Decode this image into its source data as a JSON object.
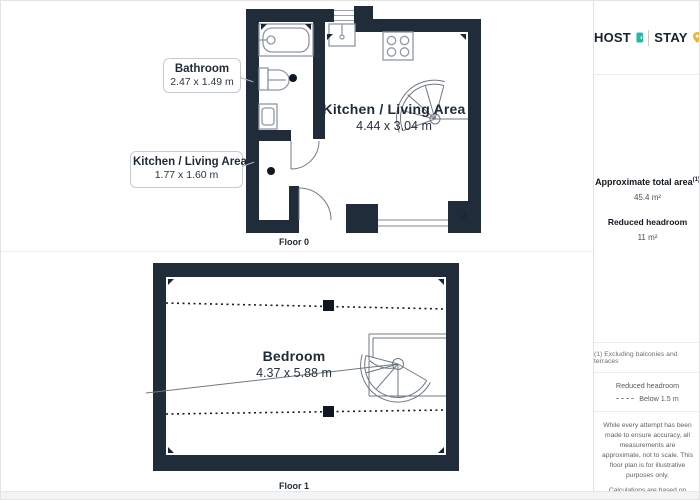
{
  "theme": {
    "wall_color": "#212c3b",
    "fixture_stroke": "#8f98a3",
    "accent_teal": "#2db5a5",
    "accent_yellow": "#f2b42c"
  },
  "logo": {
    "host": "HOST",
    "stay": "STAY"
  },
  "floor0": {
    "label": "Floor 0",
    "room": {
      "name": "Kitchen / Living Area",
      "dims": "4.44 x 3.04 m"
    },
    "callouts": [
      {
        "name": "Bathroom",
        "dims": "2.47 x 1.49 m"
      },
      {
        "name": "Kitchen / Living Area",
        "dims": "1.77 x 1.60 m"
      }
    ]
  },
  "floor1": {
    "label": "Floor 1",
    "room": {
      "name": "Bedroom",
      "dims": "4.37 x 5.88 m"
    }
  },
  "sidebar": {
    "area_title": "Approximate total area",
    "area_sup": "(1)",
    "area_value": "45.4 m²",
    "headroom_title": "Reduced headroom",
    "headroom_value": "11 m²",
    "footnote": "(1) Excluding balconies and terraces",
    "legend_title": "Reduced headroom",
    "legend_label": "Below 1.5 m",
    "disclaimer": "While every attempt has been made to ensure accuracy, all measurements are approximate, not to scale. This floor plan is for illustrative purposes only.",
    "standard": "Calculations are based on RICS IPMS 3C standard.",
    "brand": "GIRAFFE",
    "brand_bold": "360"
  }
}
